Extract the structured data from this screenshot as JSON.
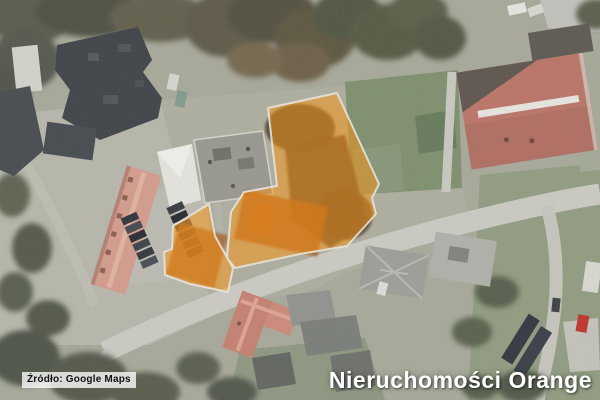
{
  "attribution": {
    "label": "Źródło: Google Maps"
  },
  "watermark": {
    "label": "Nieruchomości Orange",
    "color": "#FFFFFF"
  },
  "map": {
    "imagery": "satellite",
    "highlight_fill": "#FF9000",
    "highlight_border": "#ECE8DF",
    "parcels": {
      "large": {
        "points": "268,108 337,93 379,184 372,198 376,214 347,246 300,254 235,268 227,258 231,212 244,192 277,186"
      },
      "small": {
        "points": "209,204 173,226 172,249 164,252 165,275 190,284 228,292 233,268 215,236"
      }
    }
  }
}
